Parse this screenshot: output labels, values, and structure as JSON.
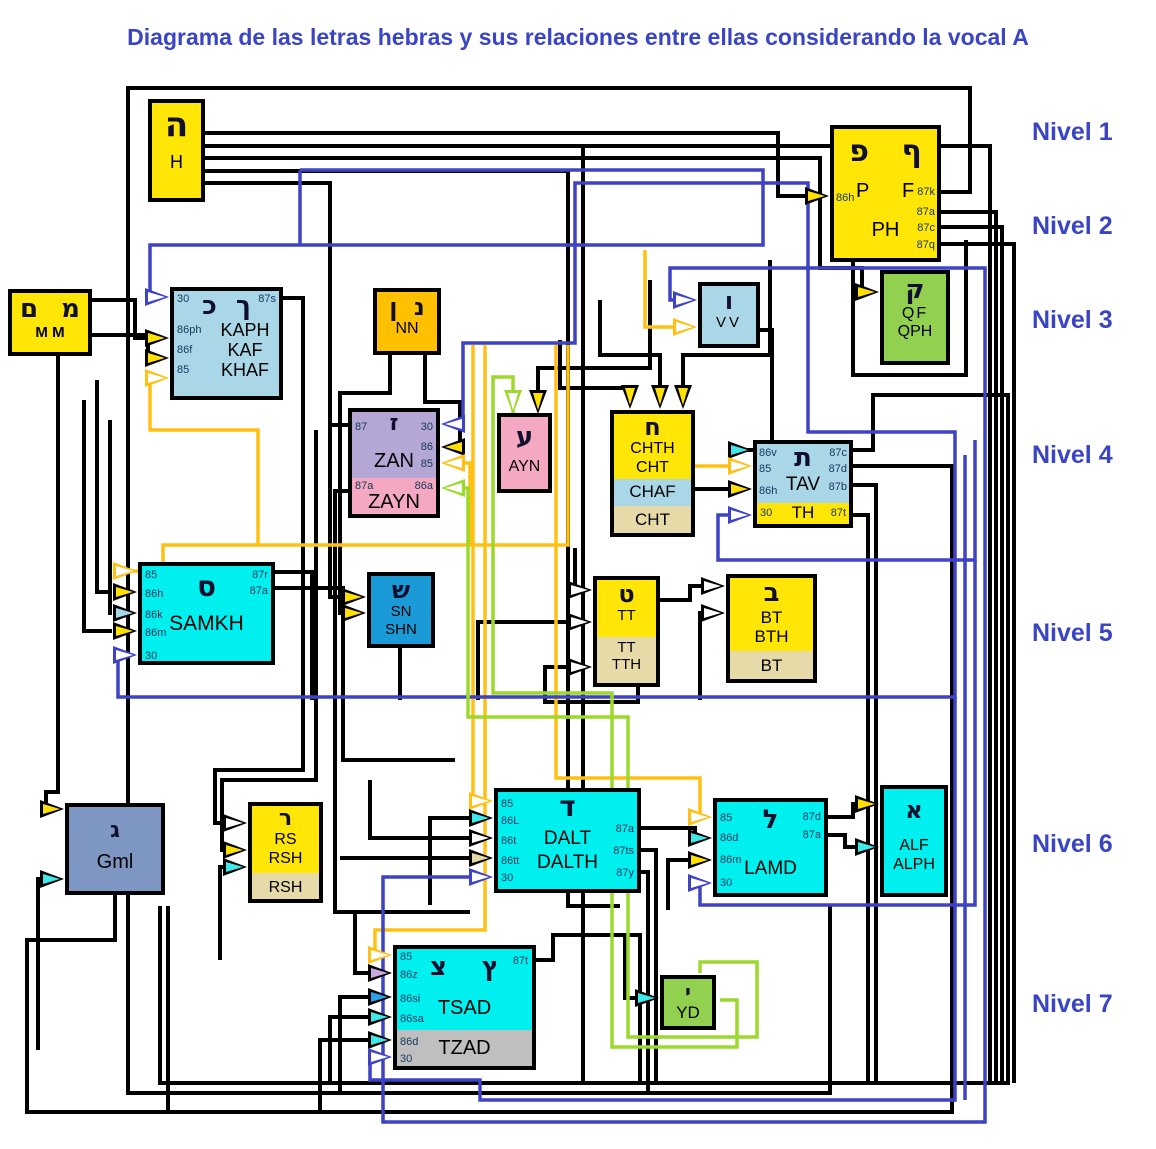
{
  "title": "Diagrama de las letras hebras y sus relaciones entre ellas considerando la vocal A",
  "levels": [
    "Nivel 1",
    "Nivel 2",
    "Nivel 3",
    "Nivel 4",
    "Nivel 5",
    "Nivel 6",
    "Nivel 7"
  ],
  "palette": {
    "nivel_blue": "#3A45C4",
    "label_navy": "#17365D",
    "wire_black": "#000000",
    "wire_blue": "#3D43C4",
    "wire_orange": "#FFC014",
    "wire_green": "#9CD92B",
    "arrow_yellow": "#FFE000",
    "arrow_cyan": "#40E8E8",
    "box_yellow": "#FFE606",
    "box_lightblue": "#A9D7E8",
    "box_orange": "#FFC000",
    "box_lavender": "#B4A7D6",
    "box_pink": "#F5A8C2",
    "box_green": "#92D050",
    "box_cyan": "#00EFEF",
    "box_blue": "#1A9AD7",
    "box_tan": "#E7DAA9",
    "box_gray": "#BFBFBF",
    "box_bluegray": "#7D96C2"
  },
  "boxes": {
    "h": {
      "hebrew": "ה",
      "name": "H"
    },
    "ph": {
      "hebrew": "פ ף",
      "p": "P",
      "f": "F",
      "name": "PH",
      "in86h": "86h",
      "out": [
        "87k",
        "87a",
        "87c",
        "87q"
      ]
    },
    "mm": {
      "hebrew": "ם מ",
      "name": "M M"
    },
    "kaph": {
      "hebrew": "כ ך",
      "tl": "30",
      "tr": "87s",
      "rows": [
        {
          "port": "86ph",
          "name": "KAPH"
        },
        {
          "port": "86f",
          "name": "KAF"
        },
        {
          "port": "85",
          "name": "KHAF"
        }
      ]
    },
    "nn": {
      "hebrew": "ן נ",
      "name": "NN"
    },
    "zan": {
      "hebrew": "ז",
      "p87": "87",
      "p30": "30",
      "p86": "86",
      "p85": "85",
      "name": "ZAN",
      "p87a": "87a",
      "p86a": "86a",
      "name2": "ZAYN"
    },
    "ayn": {
      "hebrew": "ע",
      "name": "AYN"
    },
    "vv": {
      "hebrew": "ו",
      "name": "VV"
    },
    "qf": {
      "hebrew": "ק",
      "name1": "QF",
      "name2": "QPH"
    },
    "chth": {
      "hebrew": "ח",
      "name1": "CHTH",
      "name2": "CHT",
      "sec2": "CHAF",
      "sec3": "CHT"
    },
    "tav": {
      "hebrew": "ת",
      "name": "TAV",
      "left": [
        "86v",
        "85",
        "86h"
      ],
      "right": [
        "87c",
        "87d",
        "87b"
      ],
      "b30": "30",
      "bname": "TH",
      "b87t": "87t"
    },
    "samkh": {
      "hebrew": "ס",
      "name": "SAMKH",
      "left": [
        "85",
        "86h",
        "86k",
        "86m",
        "30"
      ],
      "right": [
        "87r",
        "87a"
      ]
    },
    "sn": {
      "hebrew": "ש",
      "name1": "SN",
      "name2": "SHN"
    },
    "tt": {
      "hebrew": "ט",
      "name": "TT",
      "sec1": "TT",
      "sec2": "TTH"
    },
    "bt": {
      "hebrew": "ב",
      "name1": "BT",
      "name2": "BTH",
      "sec": "BT"
    },
    "gml": {
      "hebrew": "ג",
      "name": "Gml"
    },
    "rs": {
      "hebrew": "ר",
      "name1": "RS",
      "name2": "RSH",
      "sec": "RSH"
    },
    "dalt": {
      "hebrew": "ד",
      "name1": "DALT",
      "name2": "DALTH",
      "left": [
        "85",
        "86L",
        "86t",
        "86tt",
        "30"
      ],
      "right": [
        "87a",
        "87ts",
        "87y"
      ]
    },
    "lamd": {
      "hebrew": "ל",
      "name": "LAMD",
      "left": [
        "85",
        "86d",
        "86m",
        "30"
      ],
      "right": [
        "87d",
        "87a"
      ]
    },
    "alf": {
      "hebrew": "א",
      "name1": "ALF",
      "name2": "ALPH"
    },
    "tsad": {
      "hebrew": "צ ץ",
      "name": "TSAD",
      "sec": "TZAD",
      "tr": "87t",
      "left": [
        "85",
        "86z",
        "86si",
        "86sa",
        "86d",
        "30"
      ]
    },
    "yd": {
      "hebrew": "י",
      "name": "YD"
    }
  }
}
